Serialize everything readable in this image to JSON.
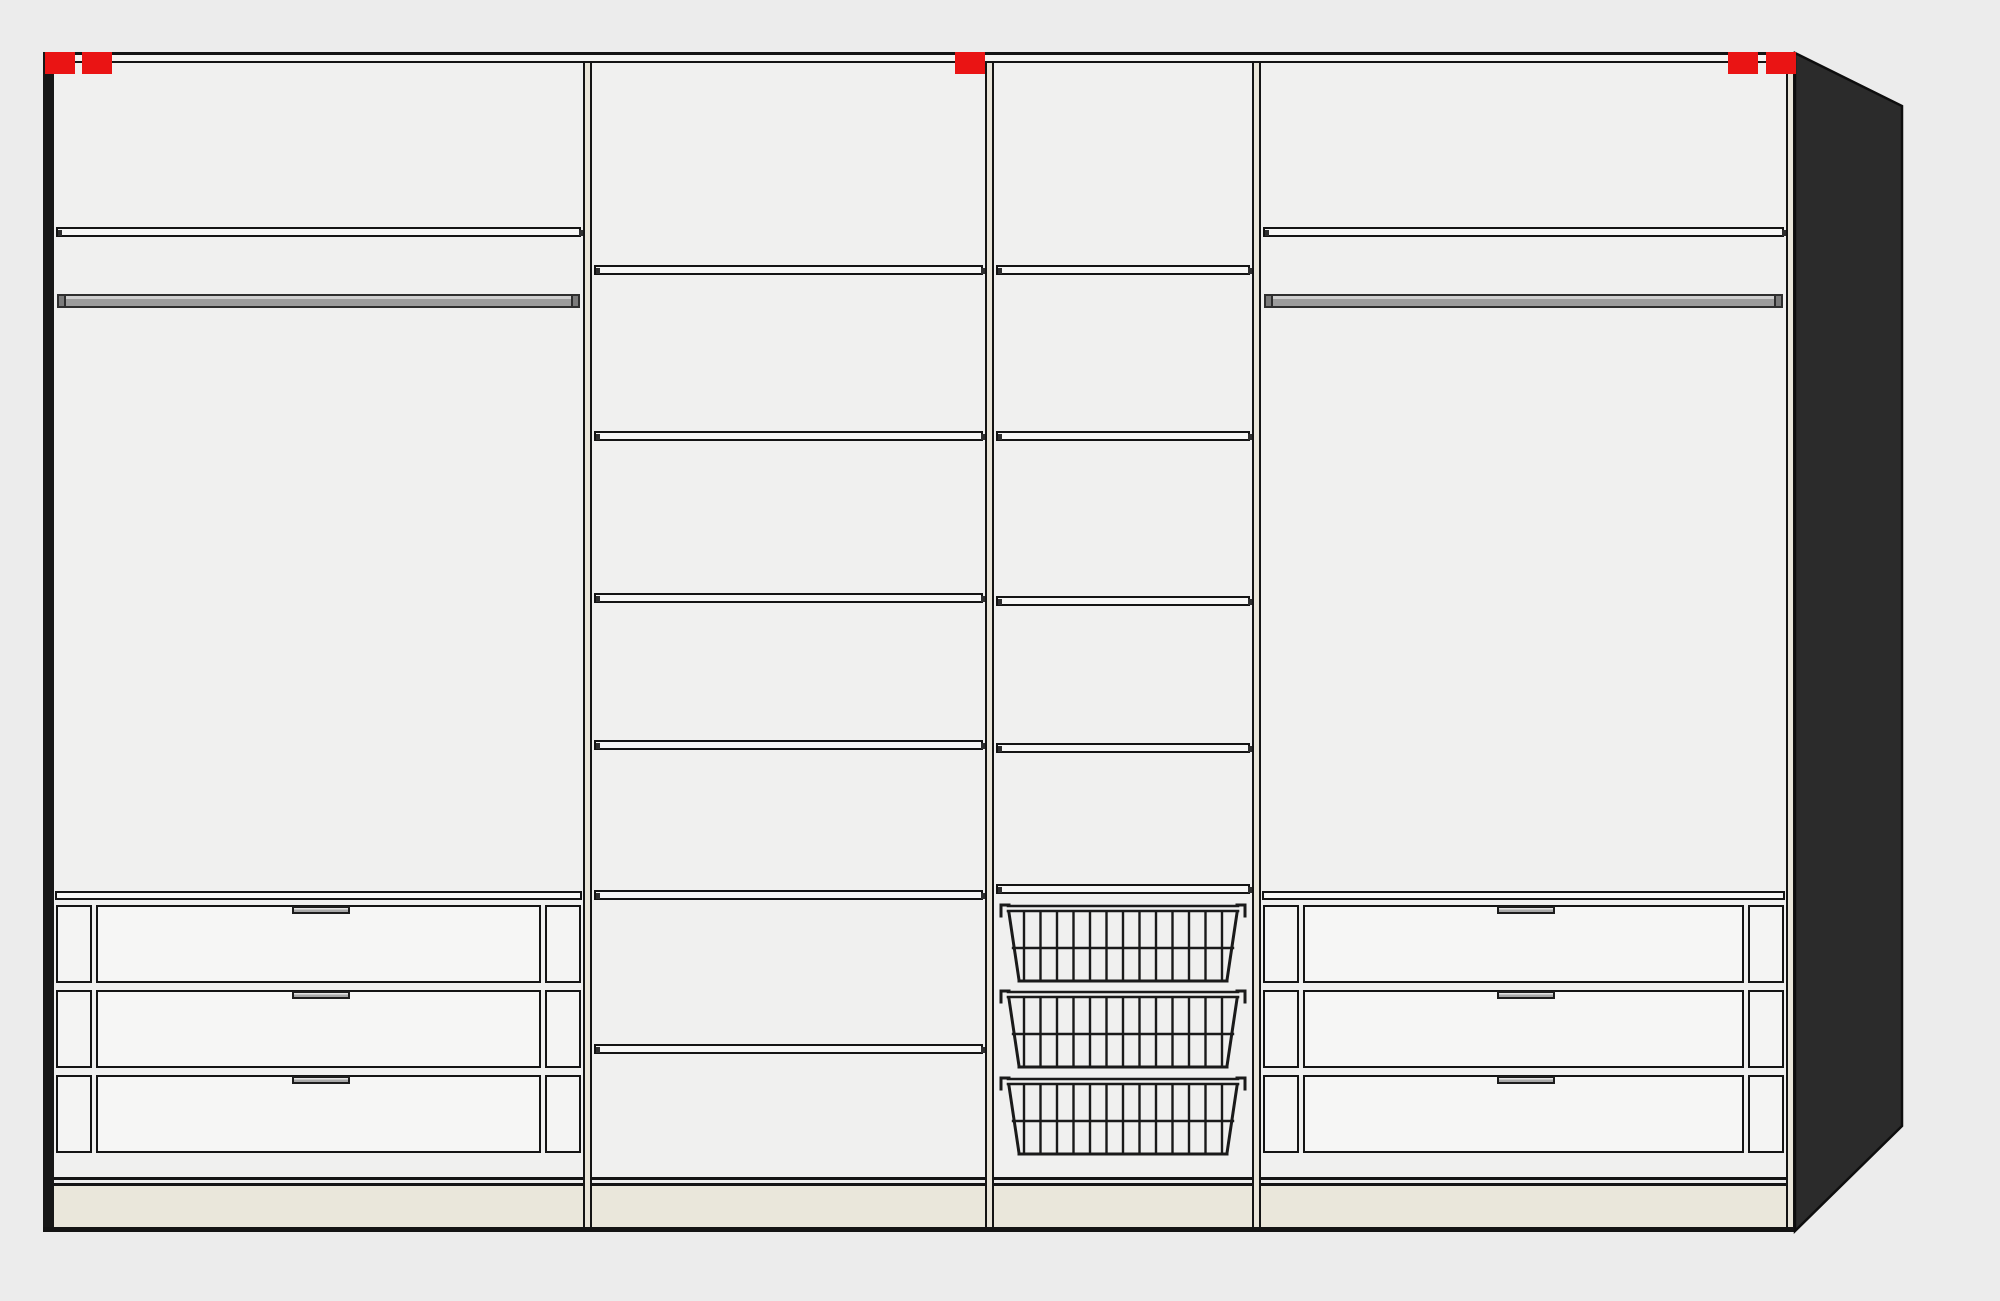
{
  "scene": {
    "kind": "wardrobe-interior-configuration-preview",
    "summary": {
      "sections": 4,
      "shelf_boards": 13,
      "drawers": 6,
      "wire_baskets": 3,
      "clothes_rails": 2,
      "red_markers": 5
    }
  },
  "colors": {
    "page_background": "#ececec",
    "interior": "#f0f0ef",
    "outline": "#141414",
    "board": "#f7f7f6",
    "plinth": "#eae7db",
    "divider_fill": "#e9e5d9",
    "side_panel": "#2b2b2b",
    "marker_red": "#ea1414",
    "rail_gray": "#9c9c9c",
    "rail_cap": "#7b7b7b",
    "handle_gray": "#a7a7a7"
  },
  "wardrobe": {
    "frame": {
      "left_bar": {
        "x": 43,
        "y": 52,
        "w": 11,
        "h": 1180
      },
      "top_band": {
        "x": 43,
        "y": 52,
        "w": 1752,
        "h": 11
      },
      "right_strip": {
        "x": 1786,
        "y": 52,
        "w": 9,
        "h": 1179
      },
      "bottom_line": {
        "x": 43,
        "y": 1227,
        "w": 1752,
        "h": 5
      }
    },
    "interior": {
      "x": 54,
      "y": 63,
      "w": 1732,
      "h": 1114
    },
    "base": {
      "line1_y": 1177,
      "line2_y": 1183,
      "line_h": 3,
      "plinth_y": 1186,
      "plinth_h": 41
    },
    "side_panel": {
      "points": "1795,53 1902,106 1902,1126 1795,1231"
    },
    "divider_xs": [
      583,
      985,
      1252
    ],
    "divider": {
      "w": 9,
      "y": 63,
      "h": 1168
    },
    "markers": {
      "y": 52,
      "w": 30,
      "h": 22,
      "xs": [
        45,
        82,
        955,
        1728,
        1766
      ]
    },
    "shelf_h": 8,
    "rail_h": 14,
    "drawer": {
      "row_h": 78,
      "stile_w": 36,
      "stile_gap": 4,
      "handle_w": 58,
      "handle_h": 8,
      "board_h": 9
    },
    "basket": {
      "h": 84,
      "wire_count": 13
    },
    "sections": [
      {
        "name": "hanging-left",
        "x": 54,
        "w": 529,
        "shelf_ys": [
          227
        ],
        "rail_y": 294,
        "drawer_unit": {
          "board_y": 891,
          "rows_y": [
            905,
            990,
            1075
          ]
        }
      },
      {
        "name": "shelf-column",
        "x": 592,
        "w": 393,
        "shelf_ys": [
          265,
          431,
          593,
          740,
          890,
          1044
        ]
      },
      {
        "name": "basket-column",
        "x": 994,
        "w": 258,
        "shelf_ys": [
          265,
          431,
          596,
          743,
          884
        ],
        "baskets_y": [
          902,
          988,
          1075
        ]
      },
      {
        "name": "hanging-right",
        "x": 1261,
        "w": 525,
        "shelf_ys": [
          227
        ],
        "rail_y": 294,
        "drawer_unit": {
          "board_y": 891,
          "rows_y": [
            905,
            990,
            1075
          ]
        }
      }
    ]
  }
}
